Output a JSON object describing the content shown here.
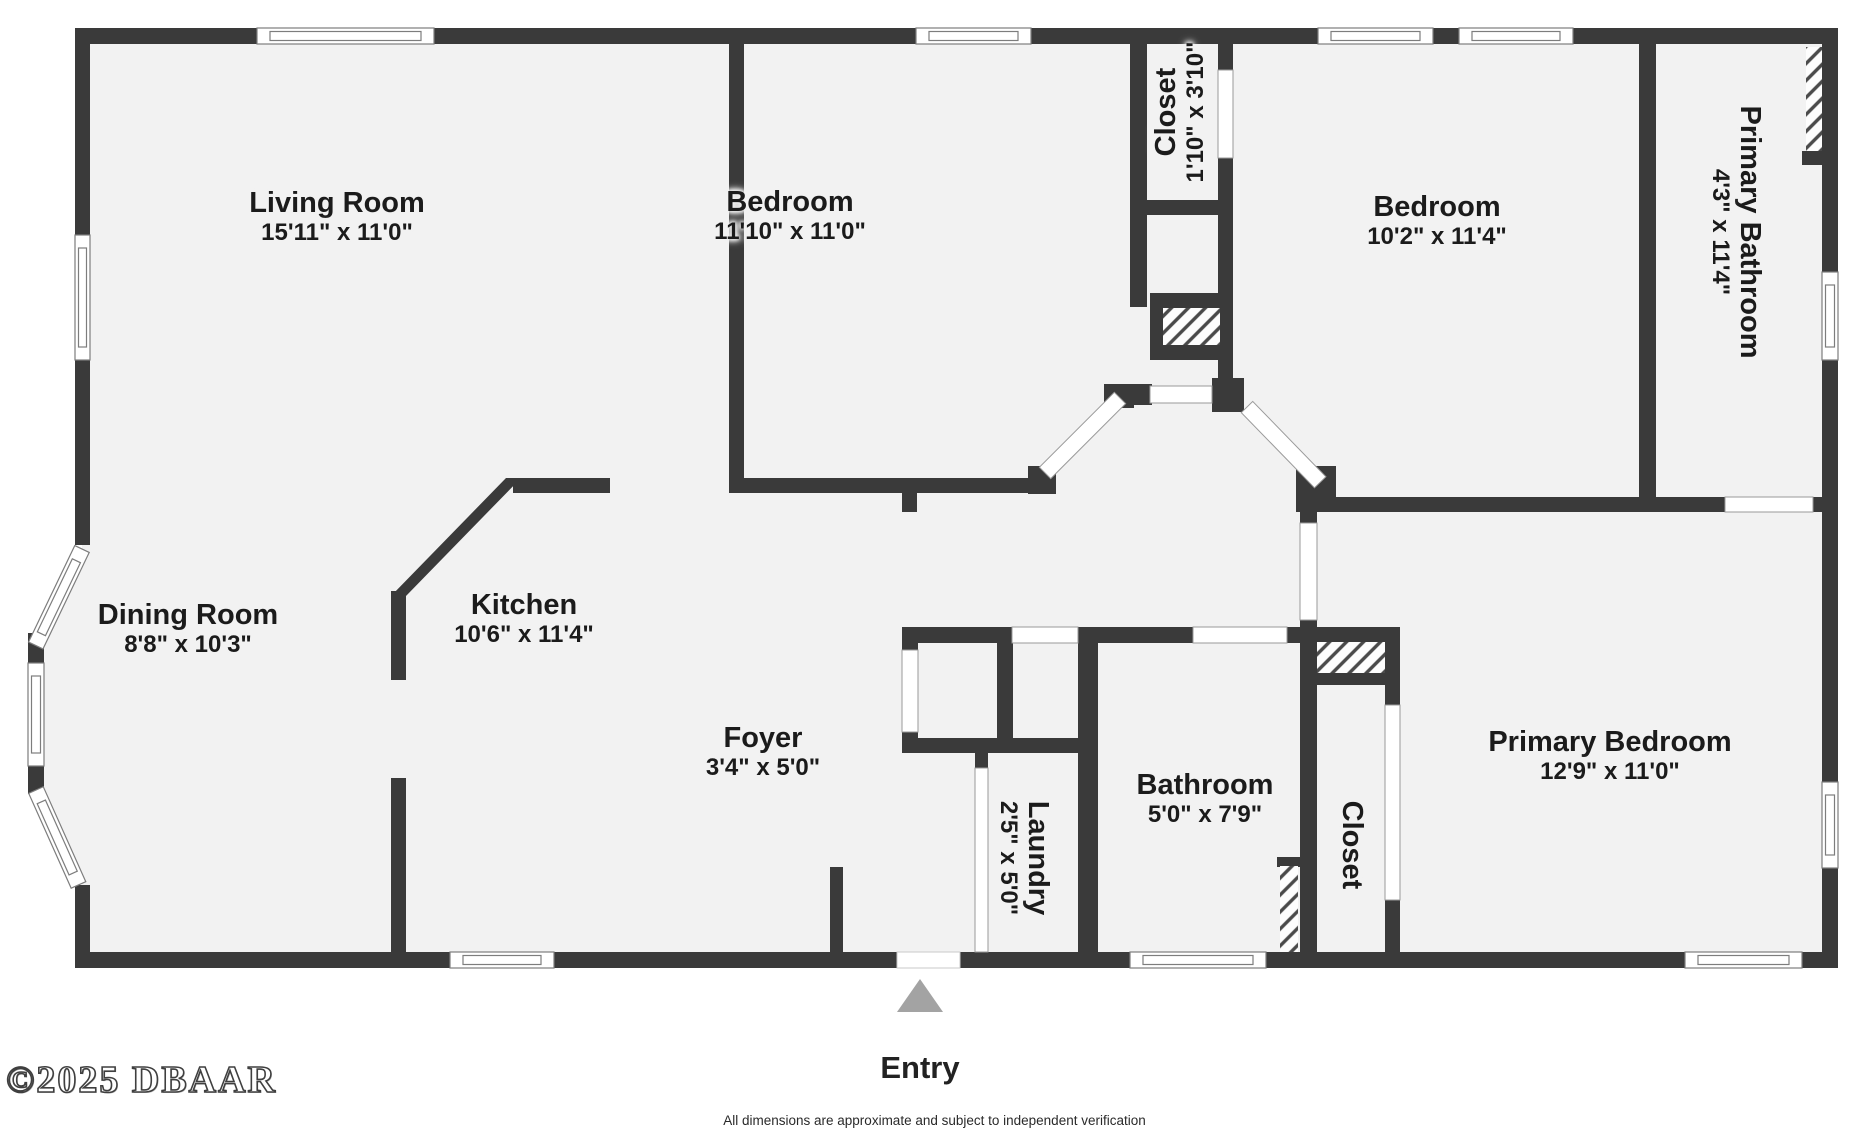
{
  "rooms": {
    "living_room": {
      "name": "Living Room",
      "dims": "15'11\" x 11'0\""
    },
    "bedroom_top": {
      "name": "Bedroom",
      "dims": "11'10\" x 11'0\""
    },
    "closet_top": {
      "name": "Closet",
      "dims": "1'10\" x 3'10\""
    },
    "bedroom_right": {
      "name": "Bedroom",
      "dims": "10'2\" x 11'4\""
    },
    "primary_bathroom": {
      "name": "Primary Bathroom",
      "dims": "4'3\" x 11'4\""
    },
    "dining_room": {
      "name": "Dining Room",
      "dims": "8'8\" x 10'3\""
    },
    "kitchen": {
      "name": "Kitchen",
      "dims": "10'6\" x 11'4\""
    },
    "foyer": {
      "name": "Foyer",
      "dims": "3'4\" x 5'0\""
    },
    "laundry": {
      "name": "Laundry",
      "dims": "2'5\" x 5'0\""
    },
    "bathroom": {
      "name": "Bathroom",
      "dims": "5'0\" x 7'9\""
    },
    "closet_primary": {
      "name": "Closet"
    },
    "primary_bedroom": {
      "name": "Primary Bedroom",
      "dims": "12'9\" x 11'0\""
    }
  },
  "entry": {
    "label": "Entry"
  },
  "footer": {
    "copyright": "©2025 DBAAR",
    "disclaimer": "All dimensions are approximate and subject to independent verification"
  },
  "colors": {
    "wall": "#3a3a3a",
    "floor": "#f2f2f2",
    "hatch_line": "#4a4a4a",
    "entry_arrow": "#a3a3a3"
  }
}
